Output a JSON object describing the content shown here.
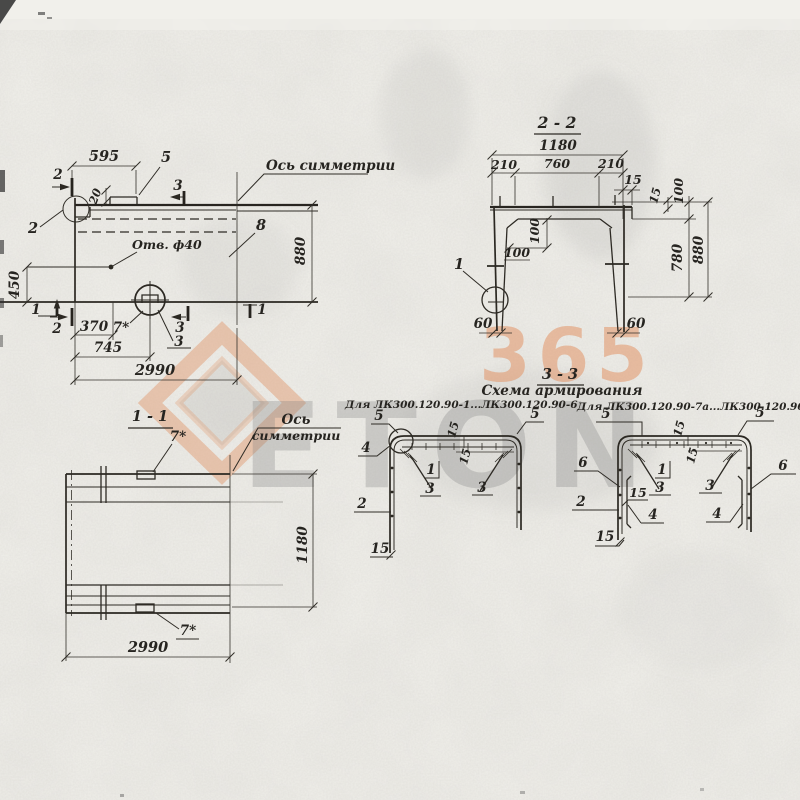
{
  "colors": {
    "ink": "#2b2822",
    "paper": "#f1f0eb",
    "watermark_orange": "#e29466",
    "watermark_gray": "#8f8f8f"
  },
  "watermark": {
    "brand": "ETON",
    "number": "365"
  },
  "plan": {
    "axis_label": "Ось симметрии",
    "hole_label": "Отв. ф40",
    "dim_595": "595",
    "dim_20": "20",
    "dim_450": "450",
    "dim_880": "880",
    "dim_370": "370",
    "dim_745": "745",
    "dim_2990": "2990",
    "mark_2_top": "2",
    "mark_2_left": "2",
    "mark_2_bottom": "2",
    "mark_3_top": "3",
    "mark_3_bottom": "3",
    "mark_1_left": "1",
    "mark_1_right": "1",
    "callout_5": "5",
    "callout_7": "7*",
    "callout_8": "8",
    "callout_3_hole": "3"
  },
  "section_2_2": {
    "title": "2 - 2",
    "dim_1180": "1180",
    "dim_210_left": "210",
    "dim_760": "760",
    "dim_210_right": "210",
    "dim_15_top": "15",
    "dim_15_right": "15",
    "dim_100_right": "100",
    "dim_100_mid_a": "100",
    "dim_100_mid_b": "100",
    "dim_780": "780",
    "dim_880": "880",
    "dim_60_left": "60",
    "dim_60_right": "60",
    "callout_1": "1"
  },
  "section_1_1": {
    "title": "1 - 1",
    "axis_line1": "Ось",
    "axis_line2": "симметрии",
    "callout_7_top": "7*",
    "callout_7_bottom": "7*",
    "dim_1180": "1180",
    "dim_2990": "2990"
  },
  "section_3_3": {
    "title": "3 - 3",
    "subtitle": "Схема армирования",
    "left_caption": "Для ЛК300.120.90-1...ЛК300.120.90-6",
    "right_caption": "Для ЛК300.120.90-7а...ЛК300.120.90-10а",
    "left": {
      "c5_left": "5",
      "c5_right": "5",
      "c4": "4",
      "c15_top": "15",
      "c15_mid": "15",
      "c1": "1",
      "c3_left": "3",
      "c3_right": "3",
      "c2": "2",
      "c15_bottom": "15"
    },
    "right": {
      "c5_left": "5",
      "c5_right": "5",
      "c15_top": "15",
      "c15_mid": "15",
      "c6_left": "6",
      "c6_right": "6",
      "c1": "1",
      "c3_left": "3",
      "c3_right": "3",
      "c2": "2",
      "c15_leg": "15",
      "c4_left": "4",
      "c4_right": "4",
      "c15_bottom": "15"
    }
  }
}
